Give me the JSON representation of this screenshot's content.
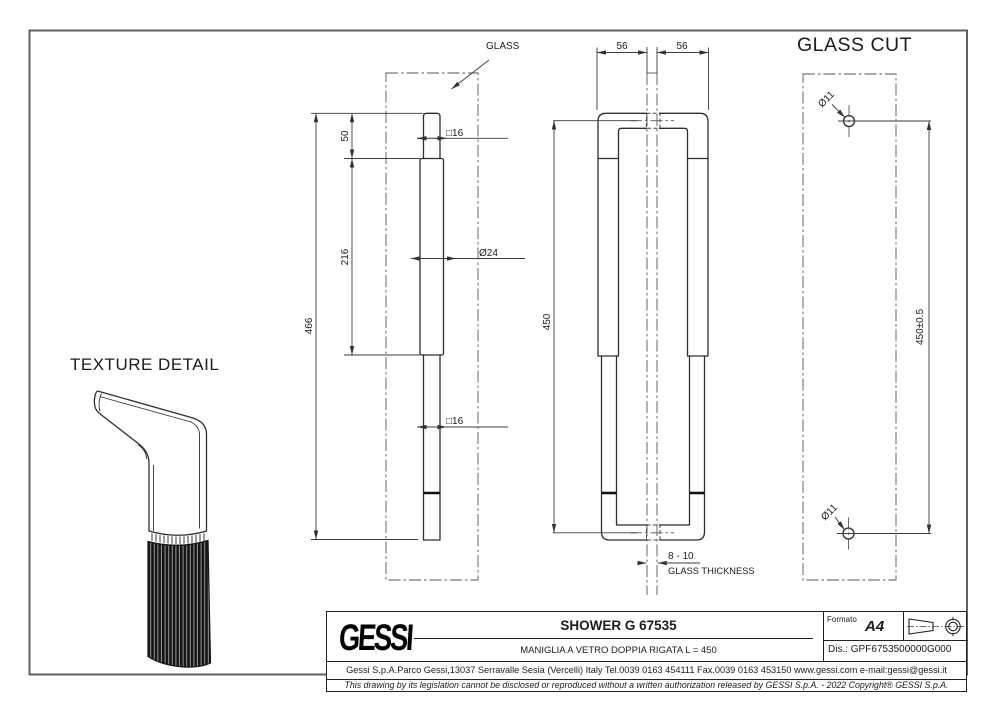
{
  "views": {
    "side_view": {
      "glass_label": "GLASS",
      "dims": {
        "top_offset": "50",
        "grip_length": "216",
        "total_length": "466",
        "square_top": "□16",
        "grip_diameter": "Ø24",
        "square_bottom": "□16"
      }
    },
    "front_view": {
      "dims": {
        "left_offset": "56",
        "right_offset": "56",
        "length": "450",
        "glass_thickness_value": "8 - 10",
        "glass_thickness_label": "GLASS THICKNESS"
      }
    },
    "glass_cut": {
      "title": "GLASS CUT",
      "dims": {
        "hole_top": "Ø11",
        "hole_bottom": "Ø11",
        "hole_distance": "450±0.5"
      }
    },
    "texture_detail": {
      "title": "TEXTURE DETAIL"
    }
  },
  "title_block": {
    "logo": "GESSI",
    "product_title": "SHOWER G 67535",
    "subtitle": "MANIGLIA A VETRO DOPPIA RIGATA L = 450",
    "address": "Gessi S.p.A.Parco Gessi,13037 Serravalle Sesia (Vercelli) Italy Tel.0039 0163 454111 Fax.0039 0163 453150 www.gessi.com e-mail:gessi@gessi.it",
    "disclaimer": "This drawing by its legislation cannot be disclosed or reproduced without a written authorization released by GESSI S.p.A. - 2022 Copyright® GESSI S.p.A.",
    "formato_label": "Formato",
    "formato_value": "A4",
    "drawing_number": "Dis.: GPF6753500000G000"
  }
}
